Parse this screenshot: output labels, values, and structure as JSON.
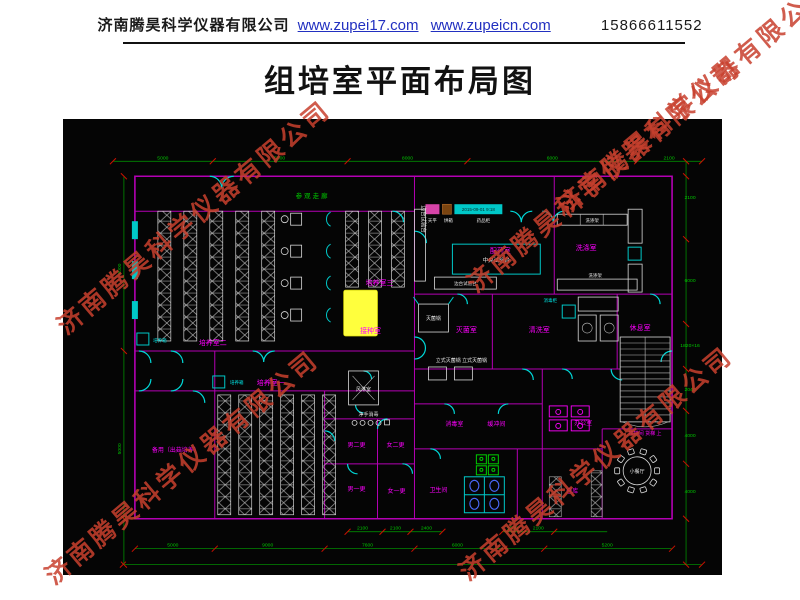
{
  "header": {
    "company": "济南腾昊科学仪器有限公司",
    "url1": "www.zupei17.com",
    "url2": "www.zupeicn.com",
    "phone": "15866611552"
  },
  "title": "组培室平面布局图",
  "watermark": {
    "text": "济南腾昊科学仪器有限公司",
    "color": "#c8402e",
    "positions": [
      {
        "x": 60,
        "y": 310
      },
      {
        "x": 470,
        "y": 268
      },
      {
        "x": 48,
        "y": 560
      },
      {
        "x": 462,
        "y": 556
      },
      {
        "x": 560,
        "y": 190
      }
    ]
  },
  "plan": {
    "colors": {
      "background": "#050505",
      "wall": "#b400b4",
      "room_label": "#ff00ff",
      "dimension": "#00c800",
      "door": "#00d8d8",
      "equipment": "#e8e8e8",
      "highlight": "#ffff3d",
      "tick": "#cc1100"
    },
    "corridor_label": "参观走廊",
    "datestamp": "2015-09-01 9:18",
    "vertical_bench_label": "边台试验台",
    "room_labels": [
      {
        "text": "培养室二",
        "x": 150,
        "y": 226
      },
      {
        "text": "培养室一",
        "x": 208,
        "y": 266
      },
      {
        "text": "培养室三",
        "x": 317,
        "y": 166
      },
      {
        "text": "接种室",
        "x": 308,
        "y": 214
      },
      {
        "text": "灭菌室",
        "x": 404,
        "y": 213
      },
      {
        "text": "配药室",
        "x": 438,
        "y": 134
      },
      {
        "text": "洗涤室",
        "x": 524,
        "y": 131
      },
      {
        "text": "清洗室",
        "x": 477,
        "y": 213
      },
      {
        "text": "休息室",
        "x": 578,
        "y": 211
      },
      {
        "text": "楼梯间 货梯 上",
        "x": 583,
        "y": 316,
        "s": 5
      },
      {
        "text": "备用（出菇培养）",
        "x": 113,
        "y": 333,
        "s": 6
      },
      {
        "text": "男二更",
        "x": 294,
        "y": 328,
        "s": 6
      },
      {
        "text": "女二更",
        "x": 333,
        "y": 328,
        "s": 6
      },
      {
        "text": "男一更",
        "x": 294,
        "y": 372,
        "s": 6
      },
      {
        "text": "女一更",
        "x": 334,
        "y": 374,
        "s": 6
      },
      {
        "text": "消毒室",
        "x": 392,
        "y": 307,
        "s": 6
      },
      {
        "text": "缓冲间",
        "x": 434,
        "y": 307,
        "s": 6
      },
      {
        "text": "卫生间",
        "x": 376,
        "y": 373,
        "s": 6
      },
      {
        "text": "办公室",
        "x": 521,
        "y": 306,
        "s": 6
      },
      {
        "text": "仓库",
        "x": 510,
        "y": 374,
        "s": 6
      }
    ],
    "equipment_labels": [
      {
        "text": "中央试验台",
        "x": 434,
        "y": 143
      },
      {
        "text": "灭菌锅",
        "x": 371,
        "y": 201,
        "s": 5
      },
      {
        "text": "立式灭菌锅 立式灭菌锅",
        "x": 399,
        "y": 243,
        "s": 5
      },
      {
        "text": "风淋室",
        "x": 301,
        "y": 272,
        "s": 5
      },
      {
        "text": "净手消毒",
        "x": 306,
        "y": 297,
        "s": 5
      },
      {
        "text": "小餐厅",
        "x": 575,
        "y": 354,
        "s": 5
      },
      {
        "text": "天平",
        "x": 370,
        "y": 103,
        "s": 4.5
      },
      {
        "text": "烘箱",
        "x": 386,
        "y": 103,
        "s": 4.5
      },
      {
        "text": "药品柜",
        "x": 421,
        "y": 103,
        "s": 4.5
      },
      {
        "text": "洗涤架",
        "x": 530,
        "y": 103,
        "s": 4.5
      },
      {
        "text": "洗涤架",
        "x": 533,
        "y": 158,
        "s": 4.5
      },
      {
        "text": "边台试验台",
        "x": 403,
        "y": 166,
        "s": 4.5
      }
    ],
    "cyan_labels": [
      {
        "text": "培养箱",
        "x": 97,
        "y": 223
      },
      {
        "text": "培养箱",
        "x": 174,
        "y": 265
      },
      {
        "text": "消毒柜",
        "x": 488,
        "y": 183
      }
    ],
    "dims": {
      "horizontal": [
        {
          "y": 42,
          "x1": 50,
          "x2": 640,
          "ticks": [
            50,
            150,
            285,
            405,
            575,
            640
          ],
          "labels": [
            {
              "v": "5000",
              "x": 100
            },
            {
              "v": "5000",
              "x": 217
            },
            {
              "v": "8000",
              "x": 345
            },
            {
              "v": "6000",
              "x": 490
            },
            {
              "v": "2100",
              "x": 607
            }
          ]
        },
        {
          "y": 413,
          "x1": 285,
          "x2": 380,
          "ticks": [
            285,
            320,
            348,
            380
          ],
          "labels": [
            {
              "v": "2100",
              "x": 300
            },
            {
              "v": "2100",
              "x": 333
            },
            {
              "v": "2400",
              "x": 364
            }
          ]
        },
        {
          "y": 413,
          "x1": 440,
          "x2": 545,
          "ticks": [
            440,
            462,
            492
          ],
          "labels": [
            {
              "v": "1500",
              "x": 450
            },
            {
              "v": "2100",
              "x": 476
            }
          ]
        },
        {
          "y": 430,
          "x1": 72,
          "x2": 610,
          "ticks": [
            72,
            152,
            262,
            352,
            442,
            482,
            610
          ],
          "labels": [
            {
              "v": "5000",
              "x": 110
            },
            {
              "v": "9000",
              "x": 205
            },
            {
              "v": "7600",
              "x": 305
            },
            {
              "v": "6000",
              "x": 395
            },
            {
              "v": "5200",
              "x": 545
            }
          ]
        },
        {
          "y": 446,
          "x1": 60,
          "x2": 640,
          "ticks": [
            60,
            640
          ],
          "labels": []
        }
      ],
      "vertical": [
        {
          "x": 61,
          "y1": 57,
          "y2": 446,
          "ticks": [
            57,
            232,
            400,
            446
          ],
          "rot": true,
          "labels": [
            {
              "v": "9000",
              "y": 150
            },
            {
              "v": "5000",
              "y": 330
            }
          ]
        },
        {
          "x": 624,
          "y1": 42,
          "y2": 446,
          "ticks": [
            42,
            57,
            120,
            205,
            250,
            292,
            345,
            400,
            446
          ],
          "rot": false,
          "labels": [
            {
              "v": "2100",
              "y": 80
            },
            {
              "v": "6000",
              "y": 163
            },
            {
              "v": "1820×16",
              "y": 228
            },
            {
              "v": "2040",
              "y": 272
            },
            {
              "v": "4000",
              "y": 318
            },
            {
              "v": "4000",
              "y": 374
            }
          ]
        }
      ]
    }
  }
}
